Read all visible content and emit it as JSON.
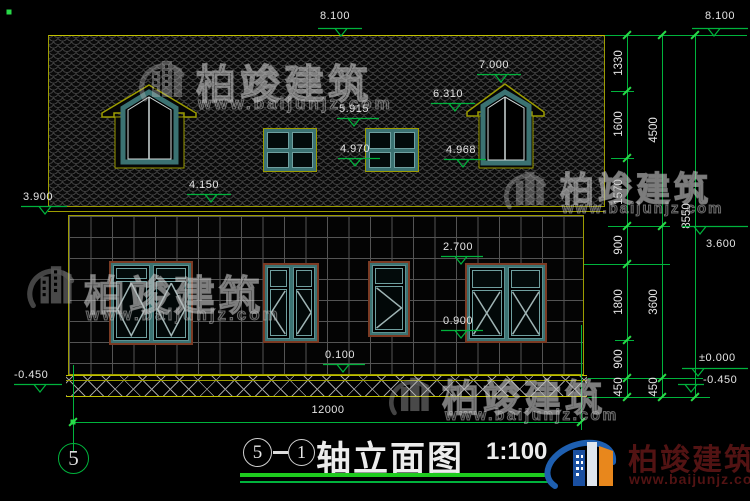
{
  "meta": {
    "brand": "柏竣建筑",
    "brand_url": "www.baijunjz.com"
  },
  "title_block": {
    "axis_from": "5",
    "axis_to": "1",
    "title": "轴立面图",
    "scale": "1:100",
    "axis_bubble": "5"
  },
  "colors": {
    "green": "#00b33c",
    "olive": "#9c9c00",
    "teal": "#3b7272",
    "brown": "#7b3b24",
    "maroon": "#521313",
    "logo_blue": "#1e5fb0",
    "logo_orange": "#e8871c"
  },
  "levels": [
    {
      "label": "8.100",
      "tx": 320,
      "ty": 10,
      "lx": 318,
      "ly": 28,
      "lw": 44,
      "ax": 341
    },
    {
      "label": "8.100",
      "tx": 705,
      "ty": 10,
      "lx": 692,
      "ly": 28,
      "lw": 56,
      "ax": 714
    },
    {
      "label": "3.900",
      "tx": 23,
      "ty": 191,
      "lx": 21,
      "ly": 206,
      "lw": 46,
      "ax": 45
    },
    {
      "label": "4.150",
      "tx": 189,
      "ty": 179,
      "lx": 187,
      "ly": 194,
      "lw": 44,
      "ax": 211
    },
    {
      "label": "7.000",
      "tx": 479,
      "ty": 59,
      "lx": 477,
      "ly": 74,
      "lw": 44,
      "ax": 501
    },
    {
      "label": "6.310",
      "tx": 433,
      "ty": 88,
      "lx": 431,
      "ly": 103,
      "lw": 44,
      "ax": 455
    },
    {
      "label": "5.915",
      "tx": 339,
      "ty": 103,
      "lx": 337,
      "ly": 118,
      "lw": 42,
      "ax": 354
    },
    {
      "label": "4.970",
      "tx": 340,
      "ty": 143,
      "lx": 338,
      "ly": 158,
      "lw": 42,
      "ax": 355
    },
    {
      "label": "4.968",
      "tx": 446,
      "ty": 144,
      "lx": 444,
      "ly": 159,
      "lw": 42,
      "ax": 463
    },
    {
      "label": "2.700",
      "tx": 443,
      "ty": 241,
      "lx": 441,
      "ly": 256,
      "lw": 42,
      "ax": 461
    },
    {
      "label": "0.900",
      "tx": 443,
      "ty": 315,
      "lx": 441,
      "ly": 330,
      "lw": 42,
      "ax": 461
    },
    {
      "label": "0.100",
      "tx": 325,
      "ty": 349,
      "lx": 323,
      "ly": 364,
      "lw": 42,
      "ax": 343
    },
    {
      "label": "-0.450",
      "tx": 14,
      "ty": 369,
      "lx": 14,
      "ly": 384,
      "lw": 48,
      "ax": 40
    },
    {
      "label": "3.600",
      "tx": 706,
      "ty": 238,
      "lx": 682,
      "ly": 226,
      "lw": 66,
      "ax": 700
    },
    {
      "label": "±0.000",
      "tx": 699,
      "ty": 352,
      "lx": 682,
      "ly": 368,
      "lw": 66,
      "ax": 698
    },
    {
      "label": "-0.450",
      "tx": 703,
      "ty": 374,
      "lx": 678,
      "ly": 384,
      "lw": 26,
      "ax": 691
    }
  ],
  "chains": {
    "vlines": [
      {
        "x": 627,
        "y1": 35,
        "y2": 397
      },
      {
        "x": 662,
        "y1": 35,
        "y2": 397
      },
      {
        "x": 695,
        "y1": 35,
        "y2": 397
      },
      {
        "x": 73,
        "y1": 365,
        "y2": 452
      },
      {
        "x": 581,
        "y1": 325,
        "y2": 430
      }
    ],
    "hlines": [
      {
        "y": 35,
        "x1": 605,
        "x2": 747
      },
      {
        "y": 91,
        "x1": 611,
        "x2": 634
      },
      {
        "y": 158,
        "x1": 611,
        "x2": 634
      },
      {
        "y": 226,
        "x1": 608,
        "x2": 670
      },
      {
        "y": 264,
        "x1": 584,
        "x2": 670
      },
      {
        "y": 340,
        "x1": 615,
        "x2": 634
      },
      {
        "y": 378,
        "x1": 588,
        "x2": 703
      },
      {
        "y": 397,
        "x1": 588,
        "x2": 710
      },
      {
        "y": 422,
        "x1": 73,
        "x2": 581
      }
    ],
    "ticks": [
      [
        627,
        35
      ],
      [
        627,
        91
      ],
      [
        627,
        158
      ],
      [
        627,
        226
      ],
      [
        627,
        264
      ],
      [
        627,
        340
      ],
      [
        627,
        378
      ],
      [
        627,
        397
      ],
      [
        662,
        35
      ],
      [
        662,
        226
      ],
      [
        662,
        378
      ],
      [
        662,
        397
      ],
      [
        695,
        35
      ],
      [
        695,
        397
      ],
      [
        73,
        422
      ],
      [
        581,
        422
      ]
    ],
    "vlabels": [
      {
        "t": "1330",
        "x": 619,
        "y": 63
      },
      {
        "t": "1600",
        "x": 619,
        "y": 124
      },
      {
        "t": "1570",
        "x": 619,
        "y": 192
      },
      {
        "t": "900",
        "x": 619,
        "y": 245
      },
      {
        "t": "1800",
        "x": 619,
        "y": 302
      },
      {
        "t": "900",
        "x": 619,
        "y": 359
      },
      {
        "t": "450",
        "x": 619,
        "y": 387
      },
      {
        "t": "4500",
        "x": 654,
        "y": 130
      },
      {
        "t": "3600",
        "x": 654,
        "y": 302
      },
      {
        "t": "450",
        "x": 654,
        "y": 387
      },
      {
        "t": "8550",
        "x": 687,
        "y": 216
      }
    ],
    "width_dim": {
      "t": "12000",
      "x": 300,
      "y": 404
    }
  },
  "dots": [
    {
      "x": 73,
      "y": 422
    },
    {
      "x": 9,
      "y": 12
    }
  ]
}
